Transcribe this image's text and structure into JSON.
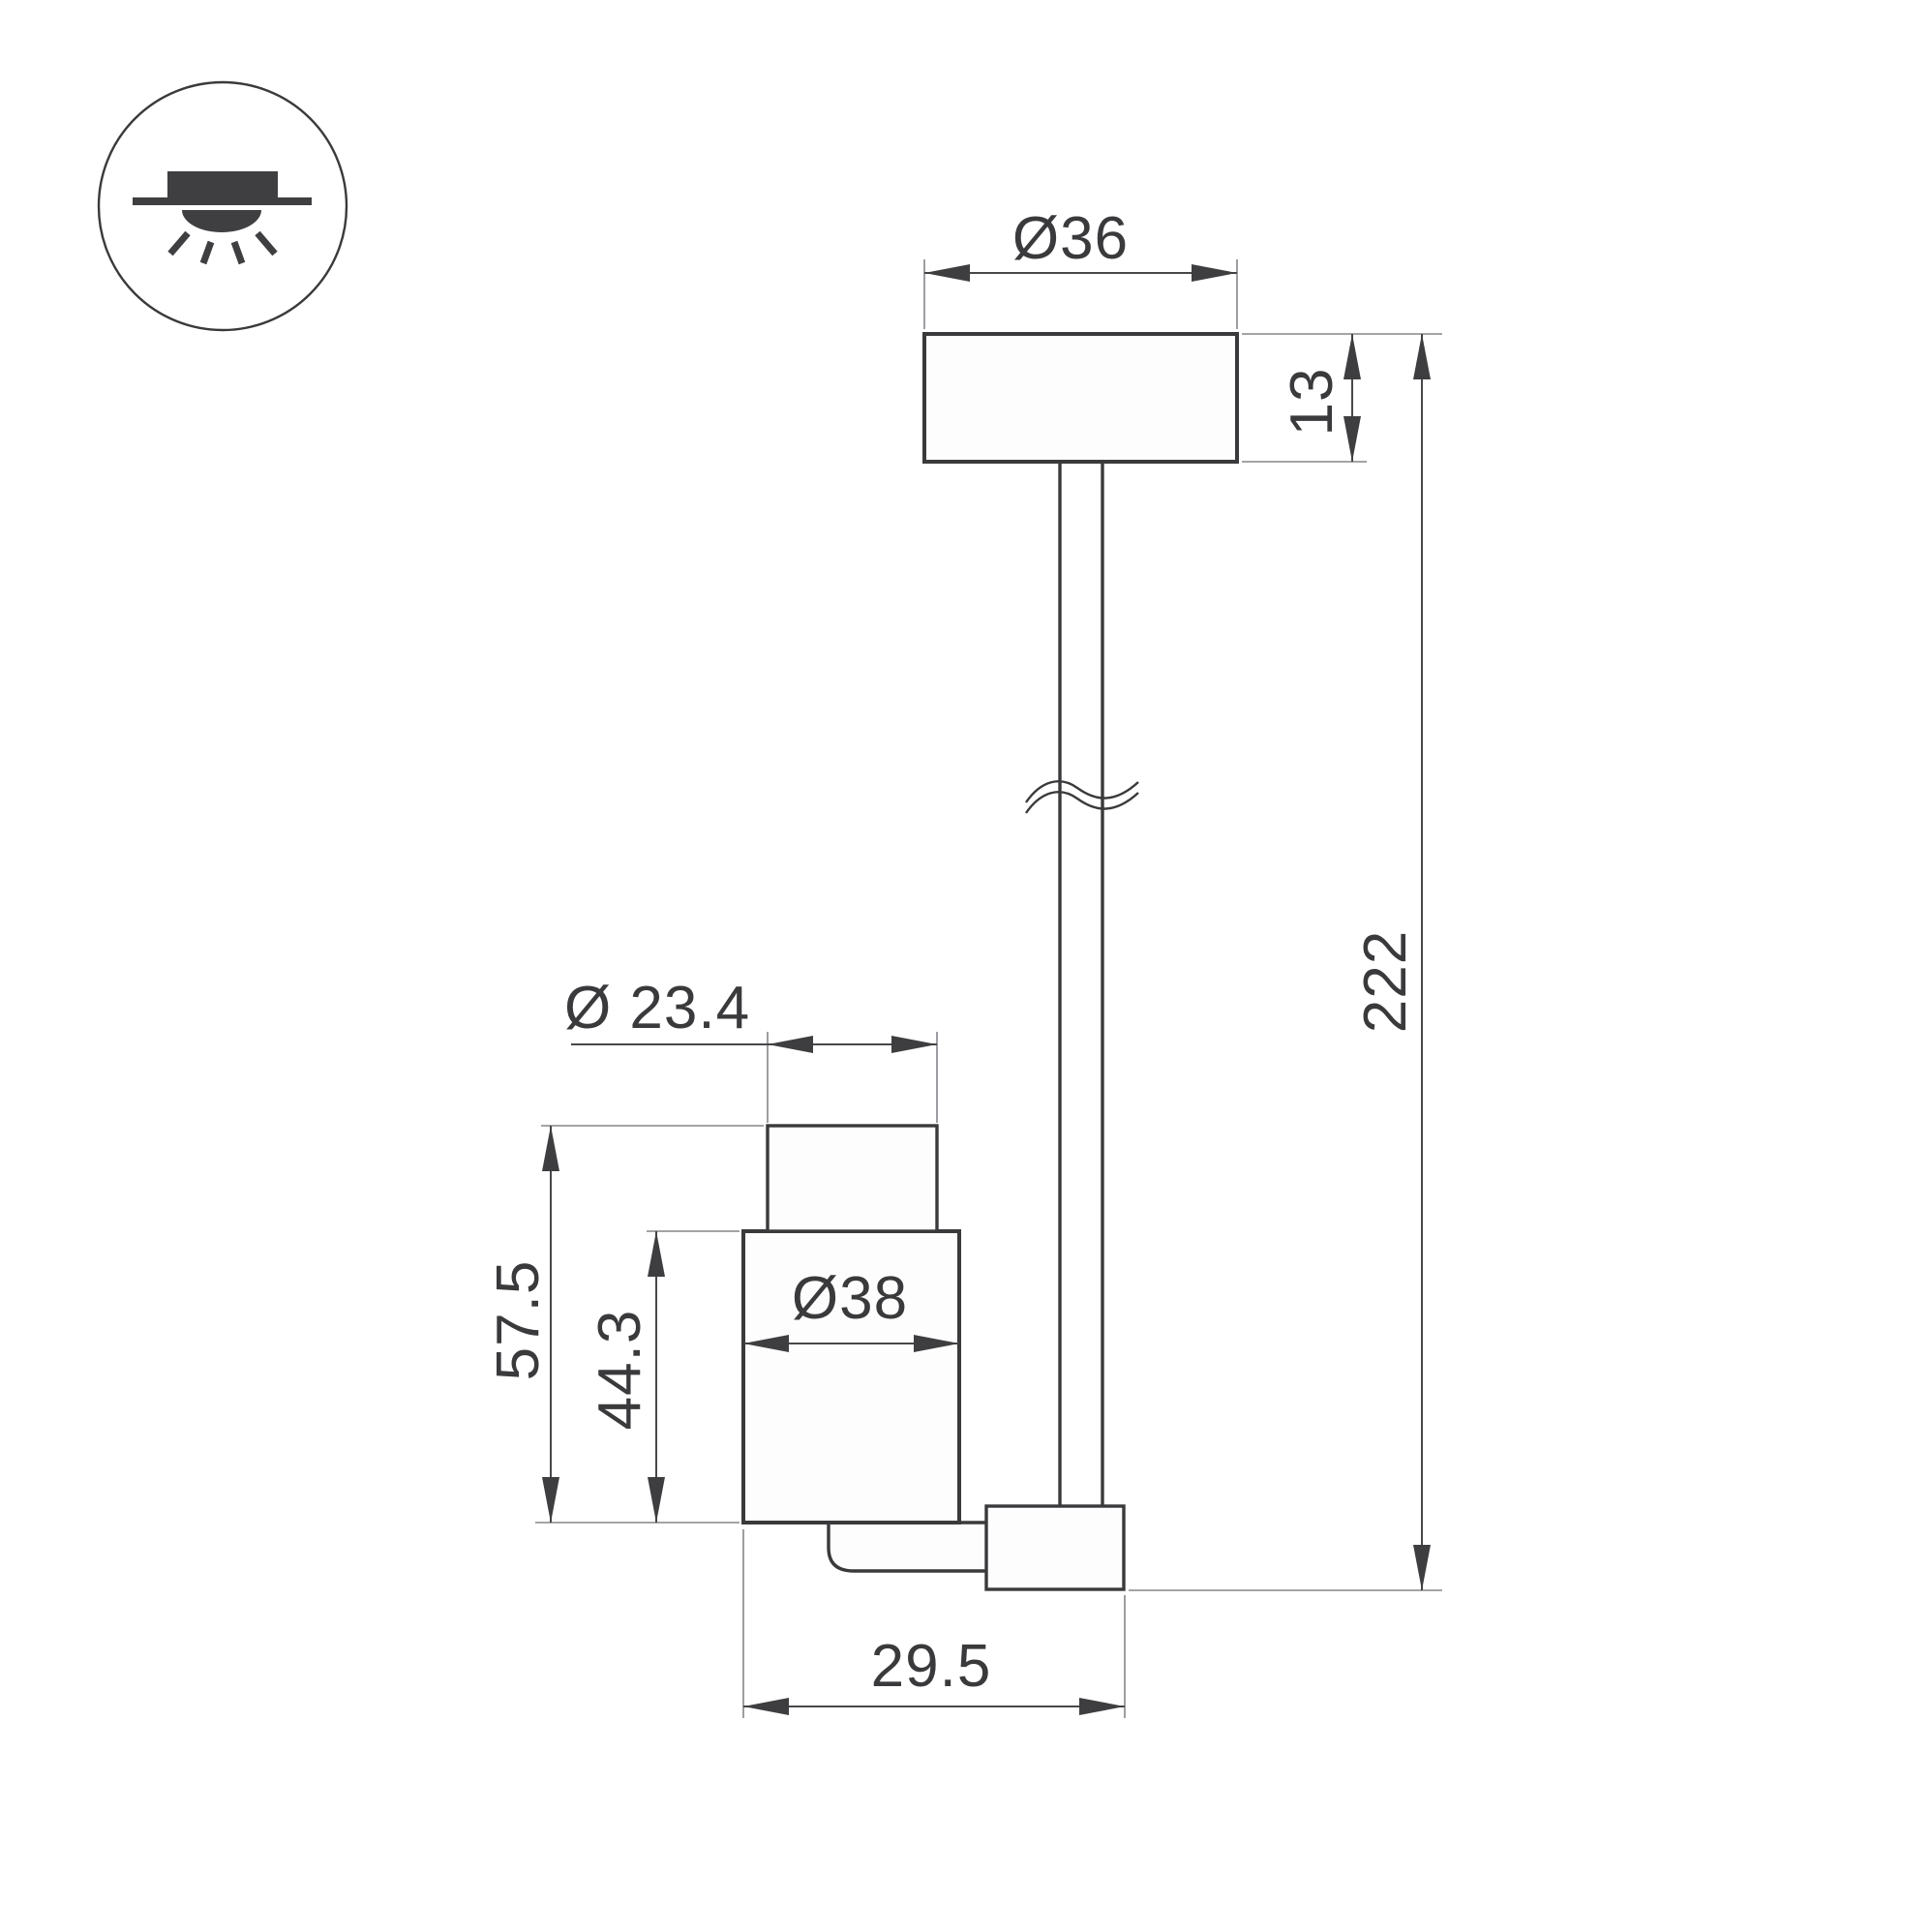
{
  "drawing": {
    "kind": "luminaire-dimension-drawing",
    "colors": {
      "outline": "#3a3a3c",
      "dimension_line": "#48484b",
      "extension_line": "#85858a",
      "shape_fill": "#fdfdfd",
      "background": "#ffffff",
      "icon": "#3f3f42"
    },
    "icon": {
      "name": "surface-ceiling-light-icon",
      "elements": [
        "ceiling-line",
        "fixture-housing",
        "light-dome",
        "light-rays"
      ]
    },
    "dimensions": {
      "canopy_diameter": "Ø36",
      "canopy_height": "13",
      "overall_height": "222",
      "head_top_diameter": "Ø 23.4",
      "head_total_height": "57.5",
      "head_body_height": "44.3",
      "head_body_diameter": "Ø38",
      "head_depth": "29.5"
    }
  }
}
